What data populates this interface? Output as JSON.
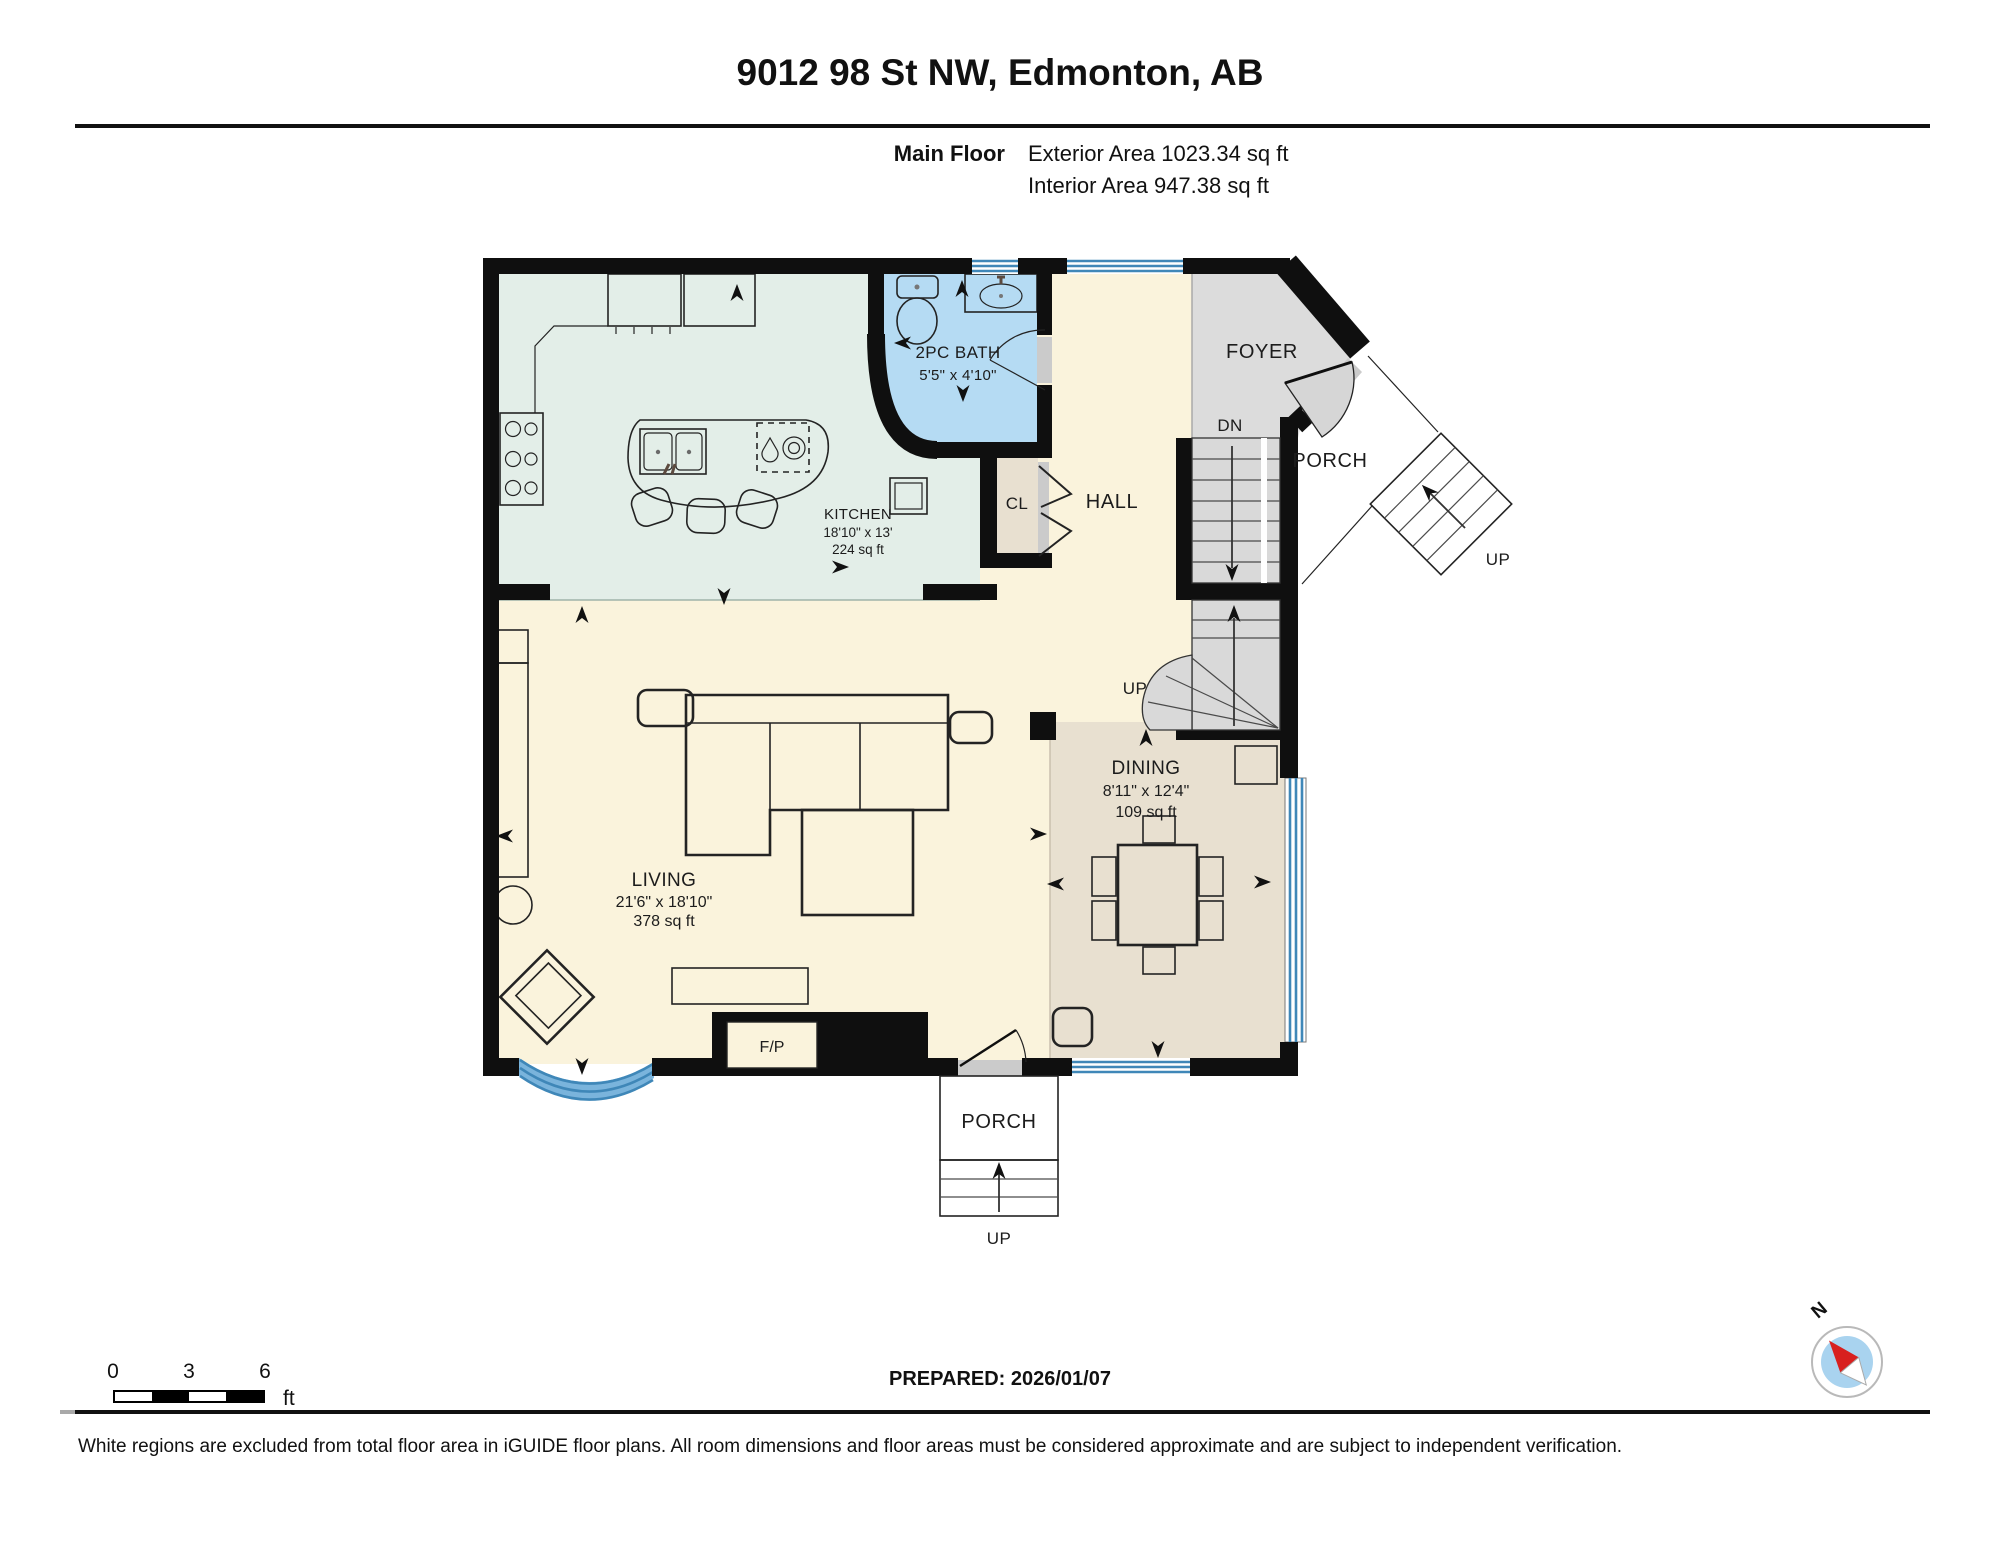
{
  "header": {
    "title": "9012 98 St NW, Edmonton, AB",
    "floor": "Main Floor",
    "exterior_area": "Exterior Area 1023.34 sq ft",
    "interior_area": "Interior Area 947.38 sq ft"
  },
  "rooms": {
    "kitchen": {
      "name": "KITCHEN",
      "dims": "18'10\" x 13'",
      "area": "224 sq ft"
    },
    "bath": {
      "name": "2PC BATH",
      "dims": "5'5\" x 4'10\""
    },
    "living": {
      "name": "LIVING",
      "dims": "21'6\" x 18'10\"",
      "area": "378 sq ft"
    },
    "dining": {
      "name": "DINING",
      "dims": "8'11\" x 12'4\"",
      "area": "109 sq ft"
    },
    "hall": "HALL",
    "foyer": "FOYER",
    "closet": "CL",
    "fireplace": "F/P",
    "porch_top": "PORCH",
    "porch_bottom": "PORCH"
  },
  "stairs": {
    "dn": "DN",
    "up_interior": "UP",
    "up_exterior_top": "UP",
    "up_exterior_bottom": "UP"
  },
  "scale_bar": {
    "t0": "0",
    "t3": "3",
    "t6": "6",
    "unit": "ft"
  },
  "prepared": "PREPARED: 2026/01/07",
  "compass": {
    "north": "N"
  },
  "disclaimer": "White regions are excluded from total floor area in iGUIDE floor plans. All room dimensions and floor areas must be considered approximate and are subject to independent verification.",
  "colors": {
    "wall": "#0f0f0f",
    "living_hall": "#faf3dc",
    "kitchen": "#e3eee8",
    "bath": "#b5dbf3",
    "dining_closet": "#e8e0d0",
    "foyer_stairs": "#dcdcdc",
    "window_blue": "#3f87b8",
    "window_band": "#7ab4dc"
  }
}
